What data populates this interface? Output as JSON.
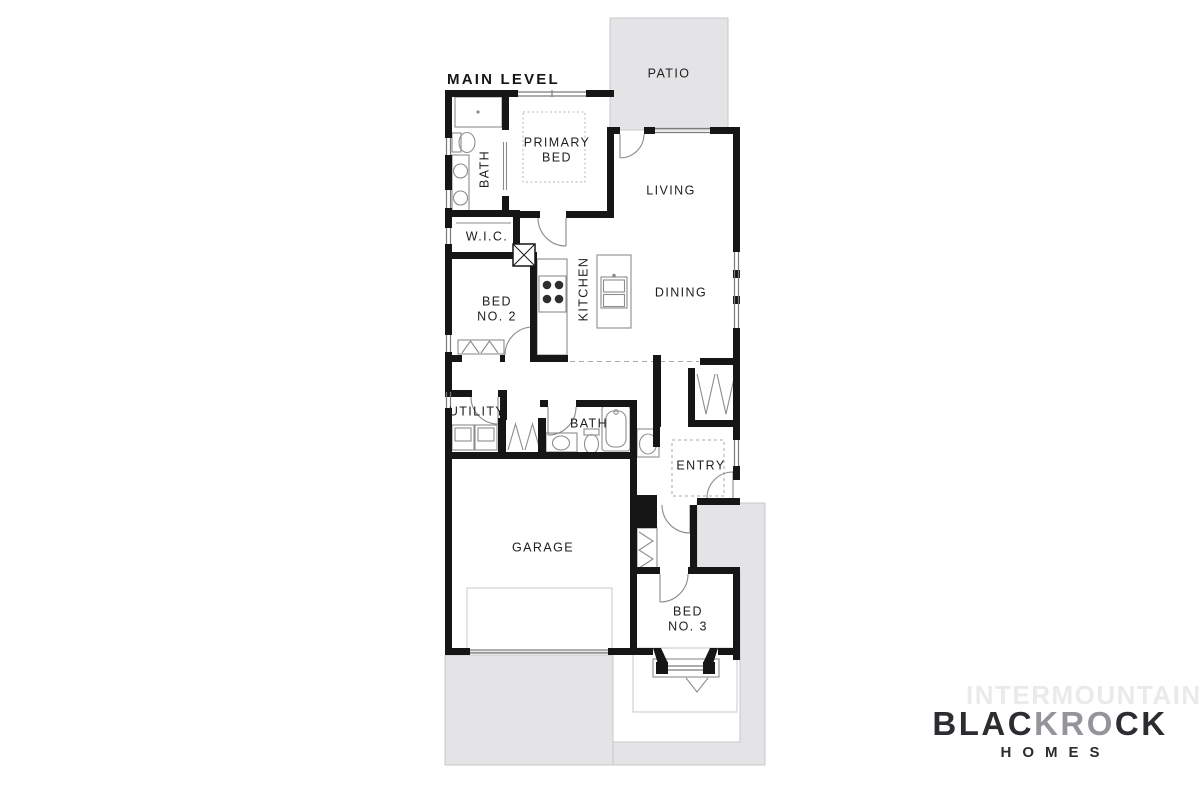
{
  "title": "MAIN LEVEL",
  "rooms": {
    "patio": "PATIO",
    "primary_bed": "PRIMARY\nBED",
    "bath_primary": "BATH",
    "living": "LIVING",
    "wic": "W.I.C.",
    "kitchen": "KITCHEN",
    "dining": "DINING",
    "bed2": "BED\nNO. 2",
    "utility": "UTILITY",
    "bath2": "BATH",
    "entry": "ENTRY",
    "garage": "GARAGE",
    "bed3": "BED\nNO. 3"
  },
  "branding": {
    "watermark": "INTERMOUNTAIN",
    "logo_part1": "BLAC",
    "logo_part2": "KRO",
    "logo_part3": "CK",
    "logo_sub": "HOMES"
  },
  "colors": {
    "wall": "#161616",
    "hardscape": "#e4e4e6",
    "hardscape_border": "#c8c8ca",
    "fixture": "#8d8d8d",
    "label": "#1e1e1e",
    "logo": "#2c2c31",
    "logo_mid": "#94949a",
    "watermark": "#eaeaec"
  }
}
